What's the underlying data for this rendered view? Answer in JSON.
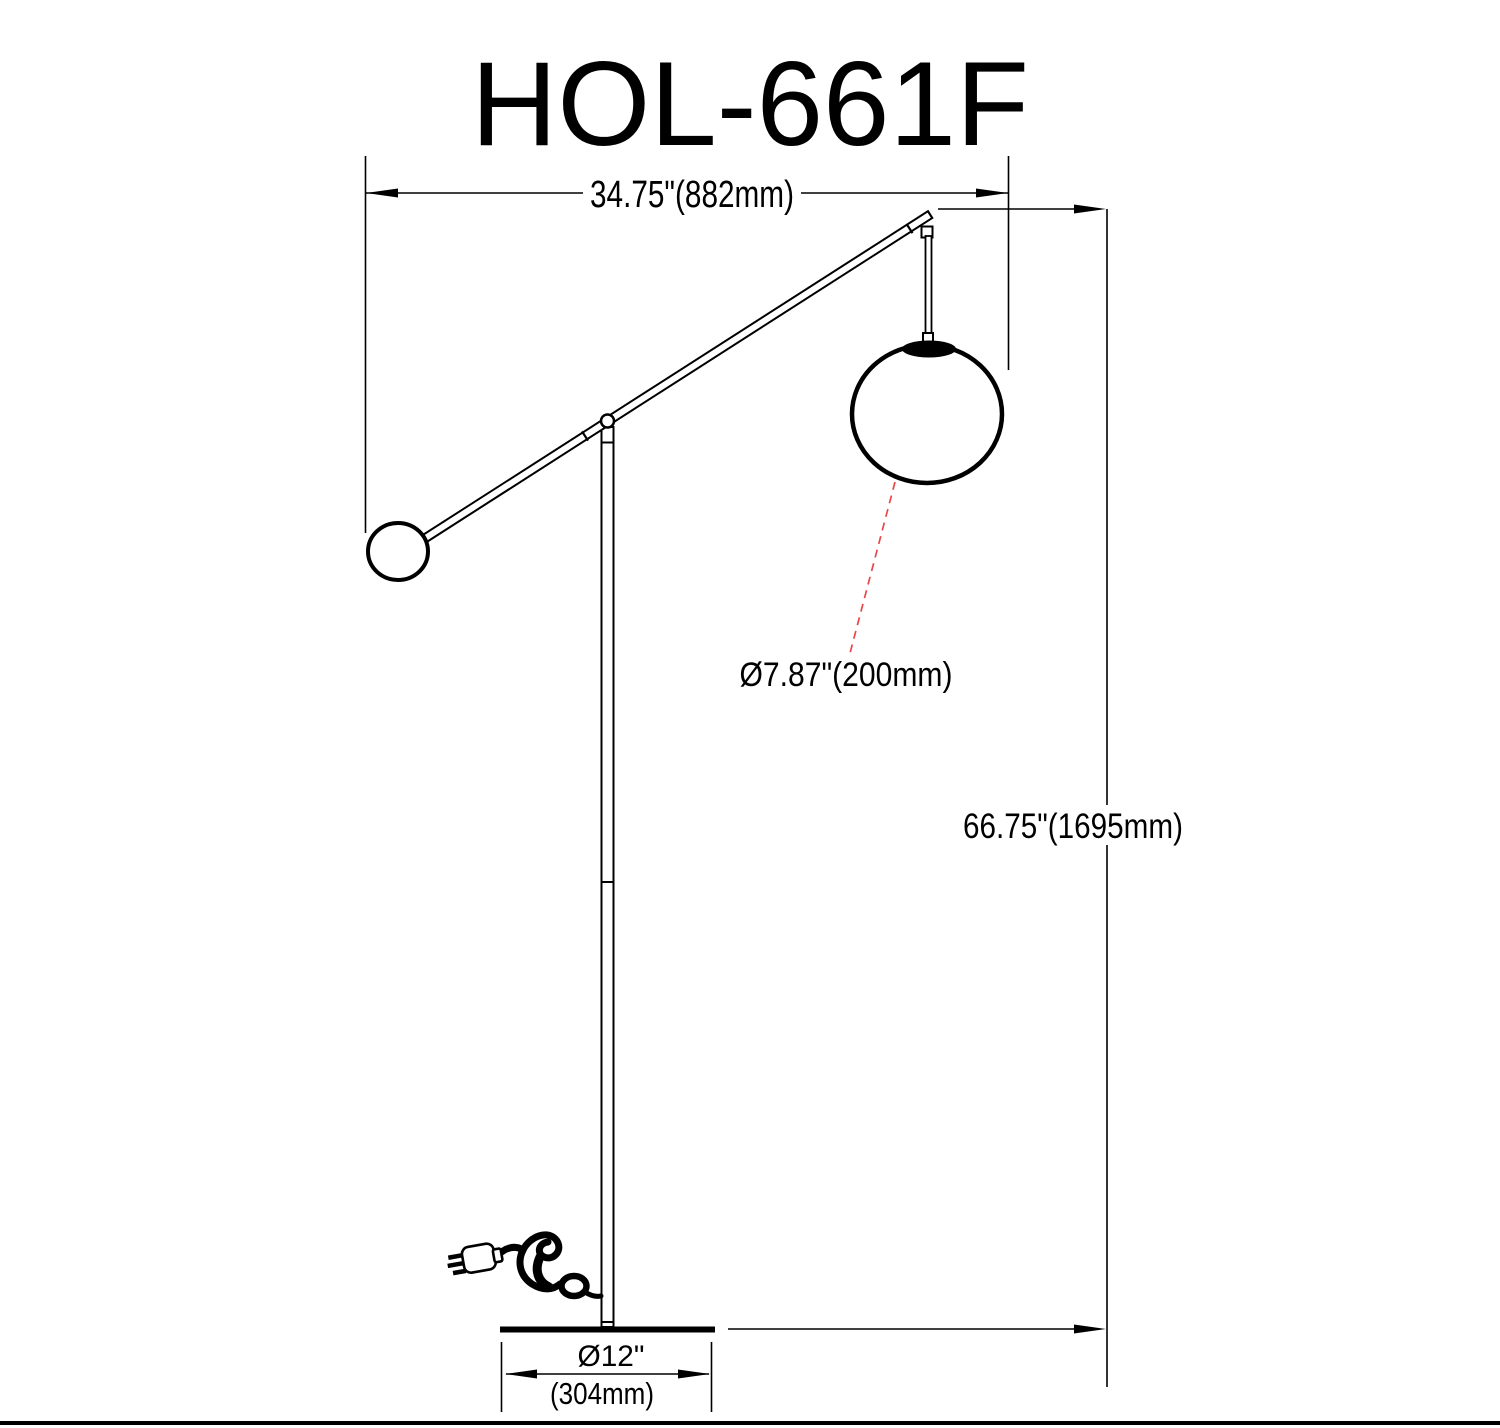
{
  "title": "HOL-661F",
  "dims": {
    "width": "34.75\"(882mm)",
    "height": "66.75\"(1695mm)",
    "globe": "Ø7.87\"(200mm)",
    "base_in": "Ø12\"",
    "base_mm": "(304mm)"
  },
  "colors": {
    "line": "#000000",
    "leader_red": "#e8484a",
    "background": "#ffffff"
  },
  "icons": {
    "power_plug": "wall-plug with prongs, tangled cord and cord-loop ring"
  }
}
